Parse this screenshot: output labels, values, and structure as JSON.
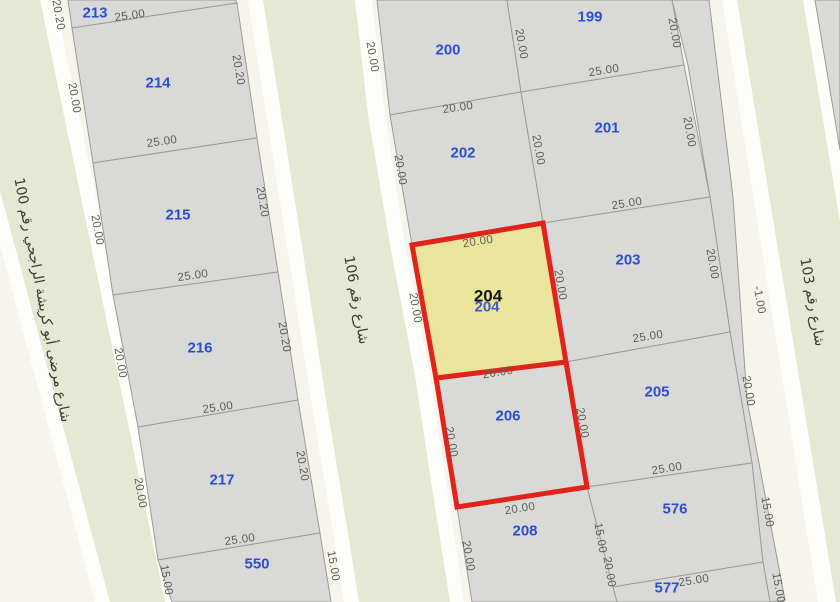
{
  "map": {
    "colors": {
      "background": "#f6f4ec",
      "street_fill": "#e5e8d2",
      "street_casing": "#fdfdf9",
      "parcel_fill": "#d9d9d7",
      "parcel_stroke": "#9c9c96",
      "highlight_fill": "#eae59b",
      "highlight_stroke": "#e2231a",
      "parcel_number_color": "#2b50cf",
      "selected_number_color": "#141414",
      "dimension_color": "#5d5d55",
      "street_name_color": "#3b3b30"
    },
    "streets": [
      {
        "name": "شارع مرضى أبو كريشة الراجحي رقم 100",
        "label": {
          "x": 42,
          "y": 300,
          "angle": 79
        },
        "casing": [
          [
            -65,
            0
          ],
          [
            55,
            0
          ],
          [
            180,
            602
          ],
          [
            95,
            602
          ]
        ],
        "surface": [
          [
            -51,
            0
          ],
          [
            40,
            0
          ],
          [
            165,
            602
          ],
          [
            110,
            602
          ]
        ]
      },
      {
        "name": "شارع رقم 106",
        "label": {
          "x": 356,
          "y": 300,
          "angle": 80
        },
        "casing": [
          [
            248,
            0
          ],
          [
            372,
            0
          ],
          [
            385,
            115
          ],
          [
            405,
            245
          ],
          [
            430,
            376
          ],
          [
            450,
            507
          ],
          [
            464,
            602
          ],
          [
            344,
            602
          ],
          [
            333,
            533
          ],
          [
            311,
            400
          ],
          [
            291,
            272
          ],
          [
            270,
            138
          ]
        ],
        "surface": [
          [
            263,
            0
          ],
          [
            355,
            0
          ],
          [
            368,
            115
          ],
          [
            390,
            245
          ],
          [
            415,
            376
          ],
          [
            435,
            507
          ],
          [
            450,
            602
          ],
          [
            359,
            602
          ],
          [
            348,
            533
          ],
          [
            326,
            400
          ],
          [
            306,
            272
          ],
          [
            285,
            138
          ]
        ]
      },
      {
        "name": "شارع رقم 103",
        "label": {
          "x": 812,
          "y": 302,
          "angle": 80
        },
        "casing": [
          [
            722,
            0
          ],
          [
            828,
            0
          ],
          [
            840,
            75
          ],
          [
            840,
            602
          ],
          [
            818,
            602
          ]
        ],
        "surface": [
          [
            737,
            0
          ],
          [
            803,
            0
          ],
          [
            840,
            222
          ],
          [
            840,
            602
          ],
          [
            836,
            602
          ]
        ]
      }
    ],
    "fragments": [
      {
        "id": "road-gore-strip",
        "points": [
          [
            672,
            0
          ],
          [
            709,
            0
          ],
          [
            733,
            197
          ],
          [
            747,
            400
          ],
          [
            785,
            600
          ],
          [
            770,
            602
          ],
          [
            763,
            562
          ],
          [
            752,
            463
          ],
          [
            730,
            332
          ],
          [
            710,
            197
          ],
          [
            688,
            65
          ]
        ]
      },
      {
        "id": "corner-parcel-ne",
        "points": [
          [
            815,
            0
          ],
          [
            840,
            0
          ],
          [
            840,
            150
          ]
        ]
      }
    ],
    "parcels": [
      {
        "number": "213",
        "points": [
          [
            68,
            0
          ],
          [
            236,
            0
          ],
          [
            237,
            3
          ],
          [
            72,
            28
          ]
        ],
        "label": {
          "x": 95,
          "y": 13
        }
      },
      {
        "number": "214",
        "points": [
          [
            72,
            28
          ],
          [
            237,
            3
          ],
          [
            257,
            138
          ],
          [
            93,
            163
          ]
        ],
        "label": {
          "x": 158,
          "y": 83
        }
      },
      {
        "number": "215",
        "points": [
          [
            93,
            163
          ],
          [
            257,
            138
          ],
          [
            278,
            272
          ],
          [
            113,
            295
          ]
        ],
        "label": {
          "x": 178,
          "y": 215
        }
      },
      {
        "number": "216",
        "points": [
          [
            113,
            295
          ],
          [
            278,
            272
          ],
          [
            298,
            400
          ],
          [
            138,
            427
          ]
        ],
        "label": {
          "x": 200,
          "y": 348
        }
      },
      {
        "number": "217",
        "points": [
          [
            138,
            427
          ],
          [
            298,
            400
          ],
          [
            320,
            533
          ],
          [
            158,
            560
          ]
        ],
        "label": {
          "x": 222,
          "y": 480
        }
      },
      {
        "number": "550",
        "points": [
          [
            158,
            560
          ],
          [
            320,
            533
          ],
          [
            331,
            602
          ],
          [
            172,
            602
          ]
        ],
        "label": {
          "x": 257,
          "y": 564
        }
      },
      {
        "number": "200",
        "points": [
          [
            377,
            0
          ],
          [
            507,
            0
          ],
          [
            521,
            92
          ],
          [
            390,
            115
          ]
        ],
        "label": {
          "x": 448,
          "y": 50
        }
      },
      {
        "number": "199",
        "points": [
          [
            507,
            0
          ],
          [
            672,
            0
          ],
          [
            684,
            65
          ],
          [
            521,
            92
          ]
        ],
        "label": {
          "x": 590,
          "y": 17
        }
      },
      {
        "number": "202",
        "points": [
          [
            390,
            115
          ],
          [
            521,
            92
          ],
          [
            543,
            223
          ],
          [
            412,
            245
          ]
        ],
        "label": {
          "x": 463,
          "y": 153
        }
      },
      {
        "number": "201",
        "points": [
          [
            521,
            92
          ],
          [
            684,
            65
          ],
          [
            710,
            197
          ],
          [
            543,
            223
          ]
        ],
        "label": {
          "x": 607,
          "y": 128
        }
      },
      {
        "number": "203",
        "points": [
          [
            543,
            223
          ],
          [
            710,
            197
          ],
          [
            730,
            332
          ],
          [
            566,
            362
          ]
        ],
        "label": {
          "x": 628,
          "y": 260
        }
      },
      {
        "number": "205",
        "points": [
          [
            566,
            362
          ],
          [
            730,
            332
          ],
          [
            752,
            463
          ],
          [
            587,
            487
          ]
        ],
        "label": {
          "x": 657,
          "y": 392
        }
      },
      {
        "number": "208",
        "points": [
          [
            457,
            507
          ],
          [
            587,
            487
          ],
          [
            617,
            602
          ],
          [
            472,
            602
          ]
        ],
        "label": {
          "x": 525,
          "y": 531
        }
      },
      {
        "number": "576",
        "points": [
          [
            587,
            487
          ],
          [
            752,
            463
          ],
          [
            763,
            562
          ],
          [
            613,
            587
          ]
        ],
        "label": {
          "x": 675,
          "y": 509
        }
      },
      {
        "number": "577",
        "points": [
          [
            613,
            587
          ],
          [
            763,
            562
          ],
          [
            770,
            602
          ],
          [
            617,
            602
          ]
        ],
        "label": {
          "x": 667,
          "y": 588
        }
      },
      {
        "number": "206",
        "points": [
          [
            436,
            378
          ],
          [
            566,
            362
          ],
          [
            587,
            487
          ],
          [
            457,
            507
          ]
        ],
        "label": {
          "x": 508,
          "y": 416
        },
        "red_border": true
      },
      {
        "number": "204",
        "points": [
          [
            412,
            245
          ],
          [
            543,
            223
          ],
          [
            566,
            362
          ],
          [
            436,
            378
          ]
        ],
        "label": {
          "x": 488,
          "y": 296
        },
        "red_border": true,
        "highlight": true,
        "selected": true
      }
    ],
    "highlight_ghost": {
      "text": "204",
      "x": 487,
      "y": 307
    },
    "dimensions": [
      {
        "text": "20.20",
        "x": 58,
        "y": 15,
        "angle": 80
      },
      {
        "text": "25.00",
        "x": 130,
        "y": 16,
        "angle": -8
      },
      {
        "text": "20.00",
        "x": 74,
        "y": 98,
        "angle": 80
      },
      {
        "text": "20.20",
        "x": 238,
        "y": 70,
        "angle": 80
      },
      {
        "text": "25.00",
        "x": 162,
        "y": 142,
        "angle": -8
      },
      {
        "text": "20.00",
        "x": 97,
        "y": 230,
        "angle": 80
      },
      {
        "text": "20.20",
        "x": 262,
        "y": 202,
        "angle": 80
      },
      {
        "text": "25.00",
        "x": 193,
        "y": 276,
        "angle": -8
      },
      {
        "text": "20.00",
        "x": 120,
        "y": 363,
        "angle": 80
      },
      {
        "text": "20.20",
        "x": 284,
        "y": 337,
        "angle": 80
      },
      {
        "text": "25.00",
        "x": 218,
        "y": 408,
        "angle": -8
      },
      {
        "text": "20.00",
        "x": 140,
        "y": 493,
        "angle": 80
      },
      {
        "text": "20.20",
        "x": 302,
        "y": 466,
        "angle": 80
      },
      {
        "text": "25.00",
        "x": 240,
        "y": 540,
        "angle": -8
      },
      {
        "text": "15.00",
        "x": 166,
        "y": 580,
        "angle": 80
      },
      {
        "text": "15.00",
        "x": 333,
        "y": 566,
        "angle": 80
      },
      {
        "text": "20.00",
        "x": 372,
        "y": 57,
        "angle": 80
      },
      {
        "text": "20.00",
        "x": 521,
        "y": 44,
        "angle": 80
      },
      {
        "text": "20.00",
        "x": 674,
        "y": 33,
        "angle": 80
      },
      {
        "text": "25.00",
        "x": 604,
        "y": 71,
        "angle": -9
      },
      {
        "text": "20.00",
        "x": 458,
        "y": 108,
        "angle": -8
      },
      {
        "text": "20.00",
        "x": 400,
        "y": 170,
        "angle": 80
      },
      {
        "text": "20.00",
        "x": 538,
        "y": 150,
        "angle": 80
      },
      {
        "text": "20.00",
        "x": 689,
        "y": 132,
        "angle": 80
      },
      {
        "text": "25.00",
        "x": 627,
        "y": 204,
        "angle": -9
      },
      {
        "text": "20.00",
        "x": 478,
        "y": 242,
        "angle": -9
      },
      {
        "text": "20.00",
        "x": 415,
        "y": 308,
        "angle": 80
      },
      {
        "text": "20.00",
        "x": 560,
        "y": 285,
        "angle": 80
      },
      {
        "text": "25.00",
        "x": 648,
        "y": 337,
        "angle": -9
      },
      {
        "text": "20.00",
        "x": 712,
        "y": 264,
        "angle": 80
      },
      {
        "text": "20.00",
        "x": 498,
        "y": 373,
        "angle": -9
      },
      {
        "text": "20.00",
        "x": 451,
        "y": 442,
        "angle": 80
      },
      {
        "text": "20.00",
        "x": 582,
        "y": 423,
        "angle": 80
      },
      {
        "text": "20.00",
        "x": 748,
        "y": 391,
        "angle": 80
      },
      {
        "text": "25.00",
        "x": 667,
        "y": 469,
        "angle": -9
      },
      {
        "text": "20.00",
        "x": 520,
        "y": 509,
        "angle": -9
      },
      {
        "text": "20.00",
        "x": 468,
        "y": 556,
        "angle": 80
      },
      {
        "text": "15.00",
        "x": 600,
        "y": 538,
        "angle": 80
      },
      {
        "text": "20.00",
        "x": 609,
        "y": 572,
        "angle": 80
      },
      {
        "text": "15.00",
        "x": 767,
        "y": 512,
        "angle": 80
      },
      {
        "text": "25.00",
        "x": 694,
        "y": 581,
        "angle": -9
      },
      {
        "text": "15.00",
        "x": 778,
        "y": 588,
        "angle": 80
      },
      {
        "text": "-1.00",
        "x": 759,
        "y": 300,
        "angle": 80
      }
    ]
  }
}
